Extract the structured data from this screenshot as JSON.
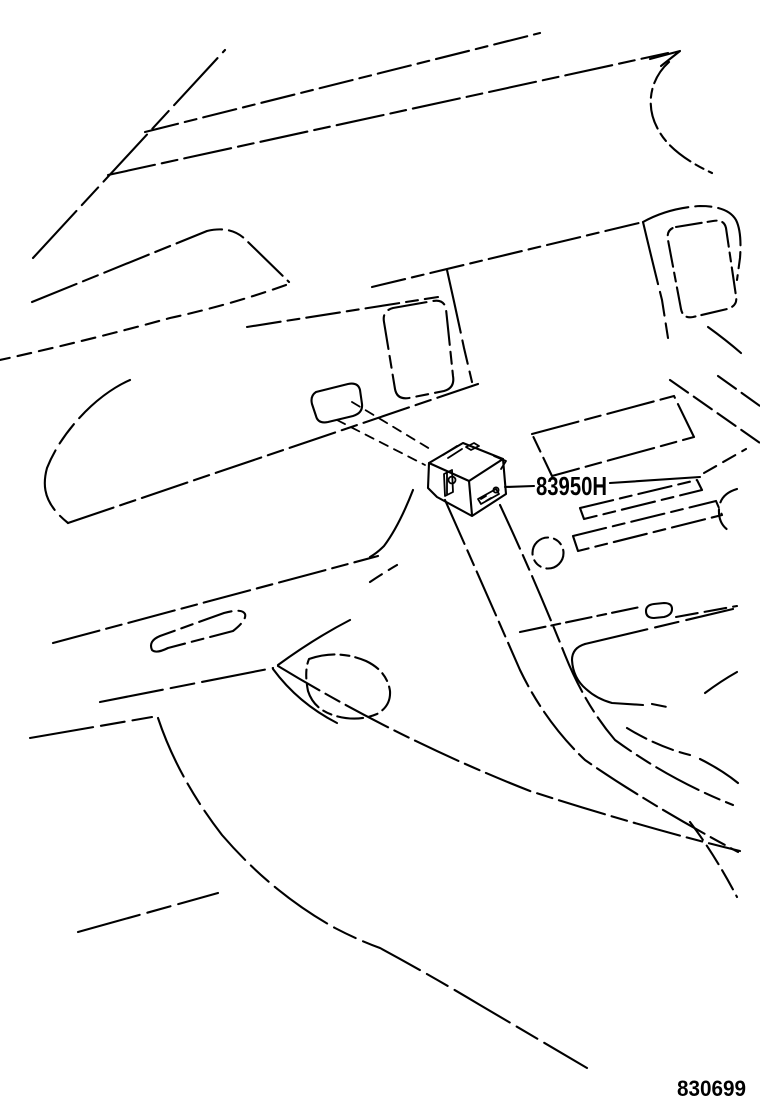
{
  "diagram": {
    "description": "vehicle instrument panel line-art",
    "part_callouts": [
      {
        "code": "83950H"
      }
    ],
    "figure_number": "830699"
  },
  "colors": {
    "line_color": "#000000",
    "background": "#ffffff"
  }
}
